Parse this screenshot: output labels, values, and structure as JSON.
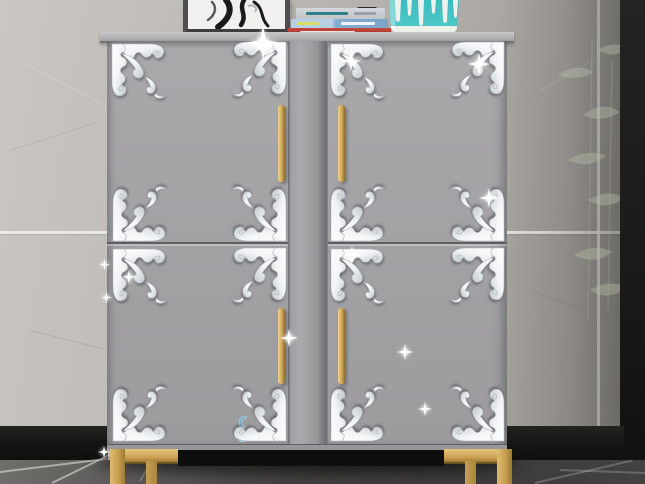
{
  "meta": {
    "subject": "Product photo: silver acrylic mirror corner decal stickers applied to a gray four-door cabinet with gold handles and gold frame legs, marble wall background"
  },
  "palette": {
    "wall": "#b5b2ae",
    "grout": "#f0eeea",
    "dark_panel": "#1d1c1b",
    "baseboard": "#151514",
    "floor_dark": "#3c3b3a",
    "floor_light": "#6f6e6a",
    "cabinet_face": "#a3a2a5",
    "cabinet_top": "#bcbbbd",
    "divider": "#9b9a9e",
    "seam": "#5e5d61",
    "gold": "#c9a45b",
    "decal_white": "#ffffff",
    "decal_shade": "#c3c9cf",
    "vase_teal": "#45c2c4",
    "book_red": "#b23a31",
    "book_blue": "#85aed0",
    "book_gray": "#c9cdd1",
    "label_yellow": "#d7de60",
    "frame_border": "#4e4e50",
    "art_ink": "#1a1a1a",
    "hook_blue": "#a6cbdc"
  },
  "props": {
    "picture_frame": {
      "label": "framed abstract ink artwork"
    },
    "books": {
      "label": "stack of three books (gray, blue, red spines)"
    },
    "black_box": {
      "label": "small black box with white dot"
    },
    "vase": {
      "label": "teal vase with white drip glaze"
    },
    "plant": {
      "label": "faint plant leaves against wall"
    },
    "hook": {
      "label": "small blue hook sticker"
    }
  },
  "cabinet": {
    "label": "gray four-door cabinet",
    "doors": 4,
    "handles": 4,
    "legs_label": "gold metal frame legs",
    "decal_count": 16
  },
  "scene": {
    "decals": [
      {
        "x": 111,
        "y": 43,
        "o": "tl"
      },
      {
        "x": 229,
        "y": 41,
        "o": "tr"
      },
      {
        "x": 112,
        "y": 184,
        "o": "bl"
      },
      {
        "x": 229,
        "y": 184,
        "o": "br"
      },
      {
        "x": 112,
        "y": 248,
        "o": "tl"
      },
      {
        "x": 229,
        "y": 247,
        "o": "tr"
      },
      {
        "x": 112,
        "y": 384,
        "o": "bl"
      },
      {
        "x": 229,
        "y": 384,
        "o": "br"
      },
      {
        "x": 330,
        "y": 43,
        "o": "tl"
      },
      {
        "x": 447,
        "y": 41,
        "o": "tr"
      },
      {
        "x": 330,
        "y": 184,
        "o": "bl"
      },
      {
        "x": 447,
        "y": 184,
        "o": "br"
      },
      {
        "x": 330,
        "y": 248,
        "o": "tl"
      },
      {
        "x": 447,
        "y": 247,
        "o": "tr"
      },
      {
        "x": 330,
        "y": 384,
        "o": "bl"
      },
      {
        "x": 447,
        "y": 384,
        "o": "br"
      }
    ],
    "sparkles": [
      {
        "x": 263,
        "y": 43,
        "s": 34
      },
      {
        "x": 351,
        "y": 61,
        "s": 20
      },
      {
        "x": 479,
        "y": 64,
        "s": 22
      },
      {
        "x": 489,
        "y": 198,
        "s": 20
      },
      {
        "x": 352,
        "y": 255,
        "s": 18
      },
      {
        "x": 129,
        "y": 277,
        "s": 14
      },
      {
        "x": 104,
        "y": 264,
        "s": 11
      },
      {
        "x": 106,
        "y": 297,
        "s": 11
      },
      {
        "x": 289,
        "y": 338,
        "s": 18
      },
      {
        "x": 405,
        "y": 352,
        "s": 16
      },
      {
        "x": 425,
        "y": 409,
        "s": 14
      },
      {
        "x": 104,
        "y": 452,
        "s": 12
      }
    ]
  }
}
